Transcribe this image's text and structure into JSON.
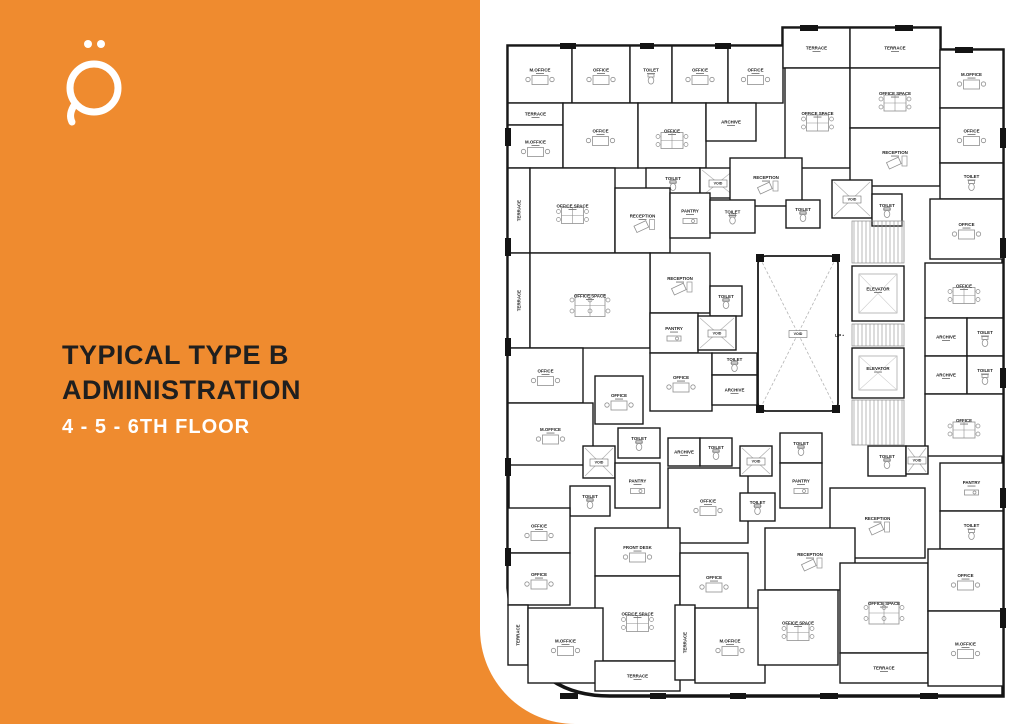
{
  "panel": {
    "title_line1": "TYPICAL TYPE B",
    "title_line2": "ADMINISTRATION",
    "subtitle": "4 - 5 - 6TH FLOOR",
    "background_color": "#EF8B2F",
    "title_color": "#1F1F1F",
    "subtitle_color": "#FFFFFF",
    "logo": "qaf-letter-mark"
  },
  "floor_plan": {
    "wall_color": "#141414",
    "room_stroke": "#1a1a1a",
    "furniture_color": "#909090",
    "up_label": "UP",
    "rooms": [
      {
        "l": "M.OFFICE",
        "t": "desk",
        "r": [
          8,
          38,
          64,
          57
        ]
      },
      {
        "l": "OFFICE",
        "t": "desk",
        "r": [
          72,
          38,
          58,
          57
        ]
      },
      {
        "l": "TOILET",
        "t": "wc",
        "r": [
          130,
          38,
          42,
          57
        ]
      },
      {
        "l": "OFFICE",
        "t": "desk",
        "r": [
          172,
          38,
          56,
          57
        ]
      },
      {
        "l": "OFFICE",
        "t": "desk",
        "r": [
          228,
          38,
          55,
          57
        ]
      },
      {
        "l": "TERRACE",
        "t": "none",
        "r": [
          283,
          20,
          67,
          40
        ]
      },
      {
        "l": "TERRACE",
        "t": "none",
        "r": [
          350,
          20,
          90,
          40
        ]
      },
      {
        "l": "OFFICE SPACE",
        "t": "cluster",
        "r": [
          285,
          60,
          65,
          100
        ]
      },
      {
        "l": "OFFICE SPACE",
        "t": "cluster",
        "r": [
          350,
          60,
          90,
          60
        ]
      },
      {
        "l": "M.OFFICE",
        "t": "desk",
        "r": [
          440,
          42,
          63,
          58
        ]
      },
      {
        "l": "TERRACE",
        "t": "none",
        "r": [
          8,
          95,
          55,
          22
        ]
      },
      {
        "l": "M.OFFICE",
        "t": "desk",
        "r": [
          8,
          117,
          55,
          43
        ]
      },
      {
        "l": "OFFICE",
        "t": "desk",
        "r": [
          63,
          95,
          75,
          65
        ]
      },
      {
        "l": "OFFICE",
        "t": "cluster",
        "r": [
          138,
          95,
          68,
          65
        ]
      },
      {
        "l": "ARCHIVE",
        "t": "none",
        "r": [
          206,
          95,
          50,
          38
        ]
      },
      {
        "l": "RECEPTION",
        "t": "recep",
        "r": [
          350,
          120,
          90,
          58
        ]
      },
      {
        "l": "OFFICE",
        "t": "desk",
        "r": [
          440,
          100,
          63,
          55
        ]
      },
      {
        "l": "TOILET",
        "t": "wc",
        "r": [
          146,
          160,
          54,
          30
        ]
      },
      {
        "l": "VOID",
        "t": "void",
        "r": [
          200,
          160,
          36,
          30
        ]
      },
      {
        "l": "RECEPTION",
        "t": "recep",
        "r": [
          230,
          150,
          72,
          48
        ]
      },
      {
        "l": "TOILET",
        "t": "wc",
        "r": [
          286,
          192,
          34,
          28
        ]
      },
      {
        "l": "VOID",
        "t": "void",
        "r": [
          332,
          172,
          40,
          38
        ]
      },
      {
        "l": "TOILET",
        "t": "wc",
        "r": [
          372,
          186,
          30,
          32
        ]
      },
      {
        "l": "TOILET",
        "t": "wc",
        "r": [
          440,
          155,
          63,
          36
        ]
      },
      {
        "l": "TERRACE",
        "t": "none",
        "r": [
          8,
          160,
          22,
          85
        ],
        "v": 1
      },
      {
        "l": "OFFICE SPACE",
        "t": "cluster",
        "r": [
          30,
          160,
          85,
          85
        ]
      },
      {
        "l": "RECEPTION",
        "t": "recep",
        "r": [
          115,
          180,
          55,
          65
        ]
      },
      {
        "l": "PANTRY",
        "t": "pantry",
        "r": [
          170,
          185,
          40,
          45
        ]
      },
      {
        "l": "TOILET",
        "t": "wc",
        "r": [
          210,
          192,
          45,
          33
        ]
      },
      {
        "l": "OFFICE",
        "t": "desk",
        "r": [
          430,
          191,
          73,
          60
        ]
      },
      {
        "l": "RECEPTION",
        "t": "recep",
        "r": [
          150,
          245,
          60,
          60
        ]
      },
      {
        "l": "TERRACE",
        "t": "none",
        "r": [
          8,
          245,
          22,
          95
        ],
        "v": 1
      },
      {
        "l": "OFFICE SPACE",
        "t": "cluster6",
        "r": [
          30,
          245,
          120,
          95
        ]
      },
      {
        "l": "TOILET",
        "t": "wc",
        "r": [
          210,
          278,
          32,
          30
        ]
      },
      {
        "l": "PANTRY",
        "t": "pantry",
        "r": [
          150,
          305,
          48,
          40
        ]
      },
      {
        "l": "VOID",
        "t": "void",
        "r": [
          198,
          308,
          38,
          34
        ]
      },
      {
        "l": "VOID",
        "t": "bigvoid",
        "r": [
          258,
          248,
          80,
          155
        ]
      },
      {
        "l": "ELEVATOR",
        "t": "elev",
        "r": [
          352,
          258,
          52,
          55
        ]
      },
      {
        "l": "ELEVATOR",
        "t": "elev",
        "r": [
          352,
          340,
          52,
          50
        ]
      },
      {
        "l": "OFFICE",
        "t": "cluster",
        "r": [
          425,
          255,
          78,
          55
        ]
      },
      {
        "l": "ARCHIVE",
        "t": "none",
        "r": [
          425,
          310,
          42,
          38
        ]
      },
      {
        "l": "TOILET",
        "t": "wc",
        "r": [
          467,
          310,
          36,
          38
        ]
      },
      {
        "l": "ARCHIVE",
        "t": "none",
        "r": [
          425,
          348,
          42,
          38
        ]
      },
      {
        "l": "TOILET",
        "t": "wc",
        "r": [
          467,
          348,
          36,
          38
        ]
      },
      {
        "l": "OFFICE",
        "t": "cluster",
        "r": [
          425,
          386,
          78,
          62
        ]
      },
      {
        "l": "OFFICE",
        "t": "desk",
        "r": [
          8,
          340,
          75,
          55
        ]
      },
      {
        "l": "OFFICE",
        "t": "desk",
        "r": [
          95,
          368,
          48,
          48
        ]
      },
      {
        "l": "OFFICE",
        "t": "desk",
        "r": [
          150,
          345,
          62,
          58
        ]
      },
      {
        "l": "TOILET",
        "t": "wc",
        "r": [
          212,
          345,
          45,
          22
        ]
      },
      {
        "l": "ARCHIVE",
        "t": "none",
        "r": [
          212,
          367,
          45,
          30
        ]
      },
      {
        "l": "M.OFFICE",
        "t": "desk",
        "r": [
          8,
          395,
          85,
          62
        ]
      },
      {
        "l": "TOILET",
        "t": "wc",
        "r": [
          118,
          420,
          42,
          30
        ]
      },
      {
        "l": "VOID",
        "t": "void",
        "r": [
          83,
          438,
          32,
          32
        ]
      },
      {
        "l": "PANTRY",
        "t": "pantry",
        "r": [
          115,
          455,
          45,
          45
        ]
      },
      {
        "l": "ARCHIVE",
        "t": "none",
        "r": [
          168,
          430,
          32,
          28
        ]
      },
      {
        "l": "TOILET",
        "t": "wc",
        "r": [
          200,
          430,
          32,
          28
        ]
      },
      {
        "l": "OFFICE",
        "t": "desk",
        "r": [
          168,
          460,
          80,
          75
        ]
      },
      {
        "l": "TOILET",
        "t": "wc",
        "r": [
          70,
          478,
          40,
          30
        ]
      },
      {
        "l": "VOID",
        "t": "void",
        "r": [
          240,
          438,
          32,
          30
        ]
      },
      {
        "l": "TOILET",
        "t": "wc",
        "r": [
          240,
          485,
          35,
          28
        ]
      },
      {
        "l": "TOILET",
        "t": "wc",
        "r": [
          280,
          425,
          42,
          30
        ]
      },
      {
        "l": "PANTRY",
        "t": "pantry",
        "r": [
          280,
          455,
          42,
          45
        ]
      },
      {
        "l": "TOILET",
        "t": "wc",
        "r": [
          368,
          438,
          38,
          30
        ]
      },
      {
        "l": "VOID",
        "t": "void",
        "r": [
          406,
          438,
          22,
          28
        ]
      },
      {
        "l": "RECEPTION",
        "t": "recep",
        "r": [
          330,
          480,
          95,
          70
        ]
      },
      {
        "l": "OFFICE",
        "t": "desk",
        "r": [
          8,
          500,
          62,
          45
        ]
      },
      {
        "l": "OFFICE",
        "t": "desk",
        "r": [
          8,
          545,
          62,
          52
        ]
      },
      {
        "l": "FRONT DESK",
        "t": "desk",
        "r": [
          95,
          520,
          85,
          48
        ]
      },
      {
        "l": "OFFICE SPACE",
        "t": "cluster",
        "r": [
          95,
          568,
          85,
          85
        ]
      },
      {
        "l": "OFFICE",
        "t": "desk",
        "r": [
          180,
          545,
          68,
          58
        ]
      },
      {
        "l": "TERRACE",
        "t": "none",
        "r": [
          8,
          597,
          20,
          60
        ],
        "v": 1
      },
      {
        "l": "M.OFFICE",
        "t": "desk",
        "r": [
          28,
          600,
          75,
          75
        ]
      },
      {
        "l": "TERRACE",
        "t": "none",
        "r": [
          95,
          653,
          85,
          30
        ]
      },
      {
        "l": "TERRACE",
        "t": "none",
        "r": [
          175,
          597,
          20,
          75
        ],
        "v": 1
      },
      {
        "l": "M.OFFICE",
        "t": "desk",
        "r": [
          195,
          600,
          70,
          75
        ]
      },
      {
        "l": "RECEPTION",
        "t": "recep",
        "r": [
          265,
          520,
          90,
          62
        ]
      },
      {
        "l": "OFFICE SPACE",
        "t": "cluster",
        "r": [
          258,
          582,
          80,
          75
        ]
      },
      {
        "l": "OFFICE SPACE",
        "t": "cluster6",
        "r": [
          340,
          555,
          88,
          90
        ]
      },
      {
        "l": "TERRACE",
        "t": "none",
        "r": [
          340,
          645,
          88,
          30
        ]
      },
      {
        "l": "PANTRY",
        "t": "pantry",
        "r": [
          440,
          455,
          63,
          48
        ]
      },
      {
        "l": "TOILET",
        "t": "wc",
        "r": [
          440,
          503,
          63,
          38
        ]
      },
      {
        "l": "OFFICE",
        "t": "desk",
        "r": [
          428,
          541,
          75,
          62
        ]
      },
      {
        "l": "M.OFFICE",
        "t": "desk",
        "r": [
          428,
          603,
          75,
          75
        ]
      }
    ],
    "stairs": [
      [
        352,
        213,
        52,
        42
      ],
      [
        352,
        316,
        52,
        22
      ],
      [
        352,
        392,
        52,
        45
      ]
    ],
    "up_pos": [
      344,
      329
    ],
    "exterior_path": "M 8,38 H 283 V 20 H 440 V 42 H 503 V 688 H 110 Q 18,688 8,580 Z",
    "wall_piers": [
      [
        60,
        35,
        16,
        6
      ],
      [
        140,
        35,
        14,
        6
      ],
      [
        215,
        35,
        16,
        6
      ],
      [
        300,
        17,
        18,
        6
      ],
      [
        395,
        17,
        18,
        6
      ],
      [
        455,
        39,
        18,
        6
      ],
      [
        500,
        120,
        6,
        20
      ],
      [
        500,
        230,
        6,
        20
      ],
      [
        500,
        360,
        6,
        20
      ],
      [
        500,
        480,
        6,
        20
      ],
      [
        500,
        600,
        6,
        20
      ],
      [
        60,
        685,
        18,
        6
      ],
      [
        150,
        685,
        16,
        6
      ],
      [
        230,
        685,
        16,
        6
      ],
      [
        320,
        685,
        18,
        6
      ],
      [
        420,
        685,
        18,
        6
      ],
      [
        5,
        120,
        6,
        18
      ],
      [
        5,
        230,
        6,
        18
      ],
      [
        5,
        330,
        6,
        18
      ],
      [
        5,
        450,
        6,
        18
      ],
      [
        5,
        540,
        6,
        18
      ],
      [
        256,
        246,
        8,
        8
      ],
      [
        332,
        246,
        8,
        8
      ],
      [
        256,
        397,
        8,
        8
      ],
      [
        332,
        397,
        8,
        8
      ]
    ]
  }
}
